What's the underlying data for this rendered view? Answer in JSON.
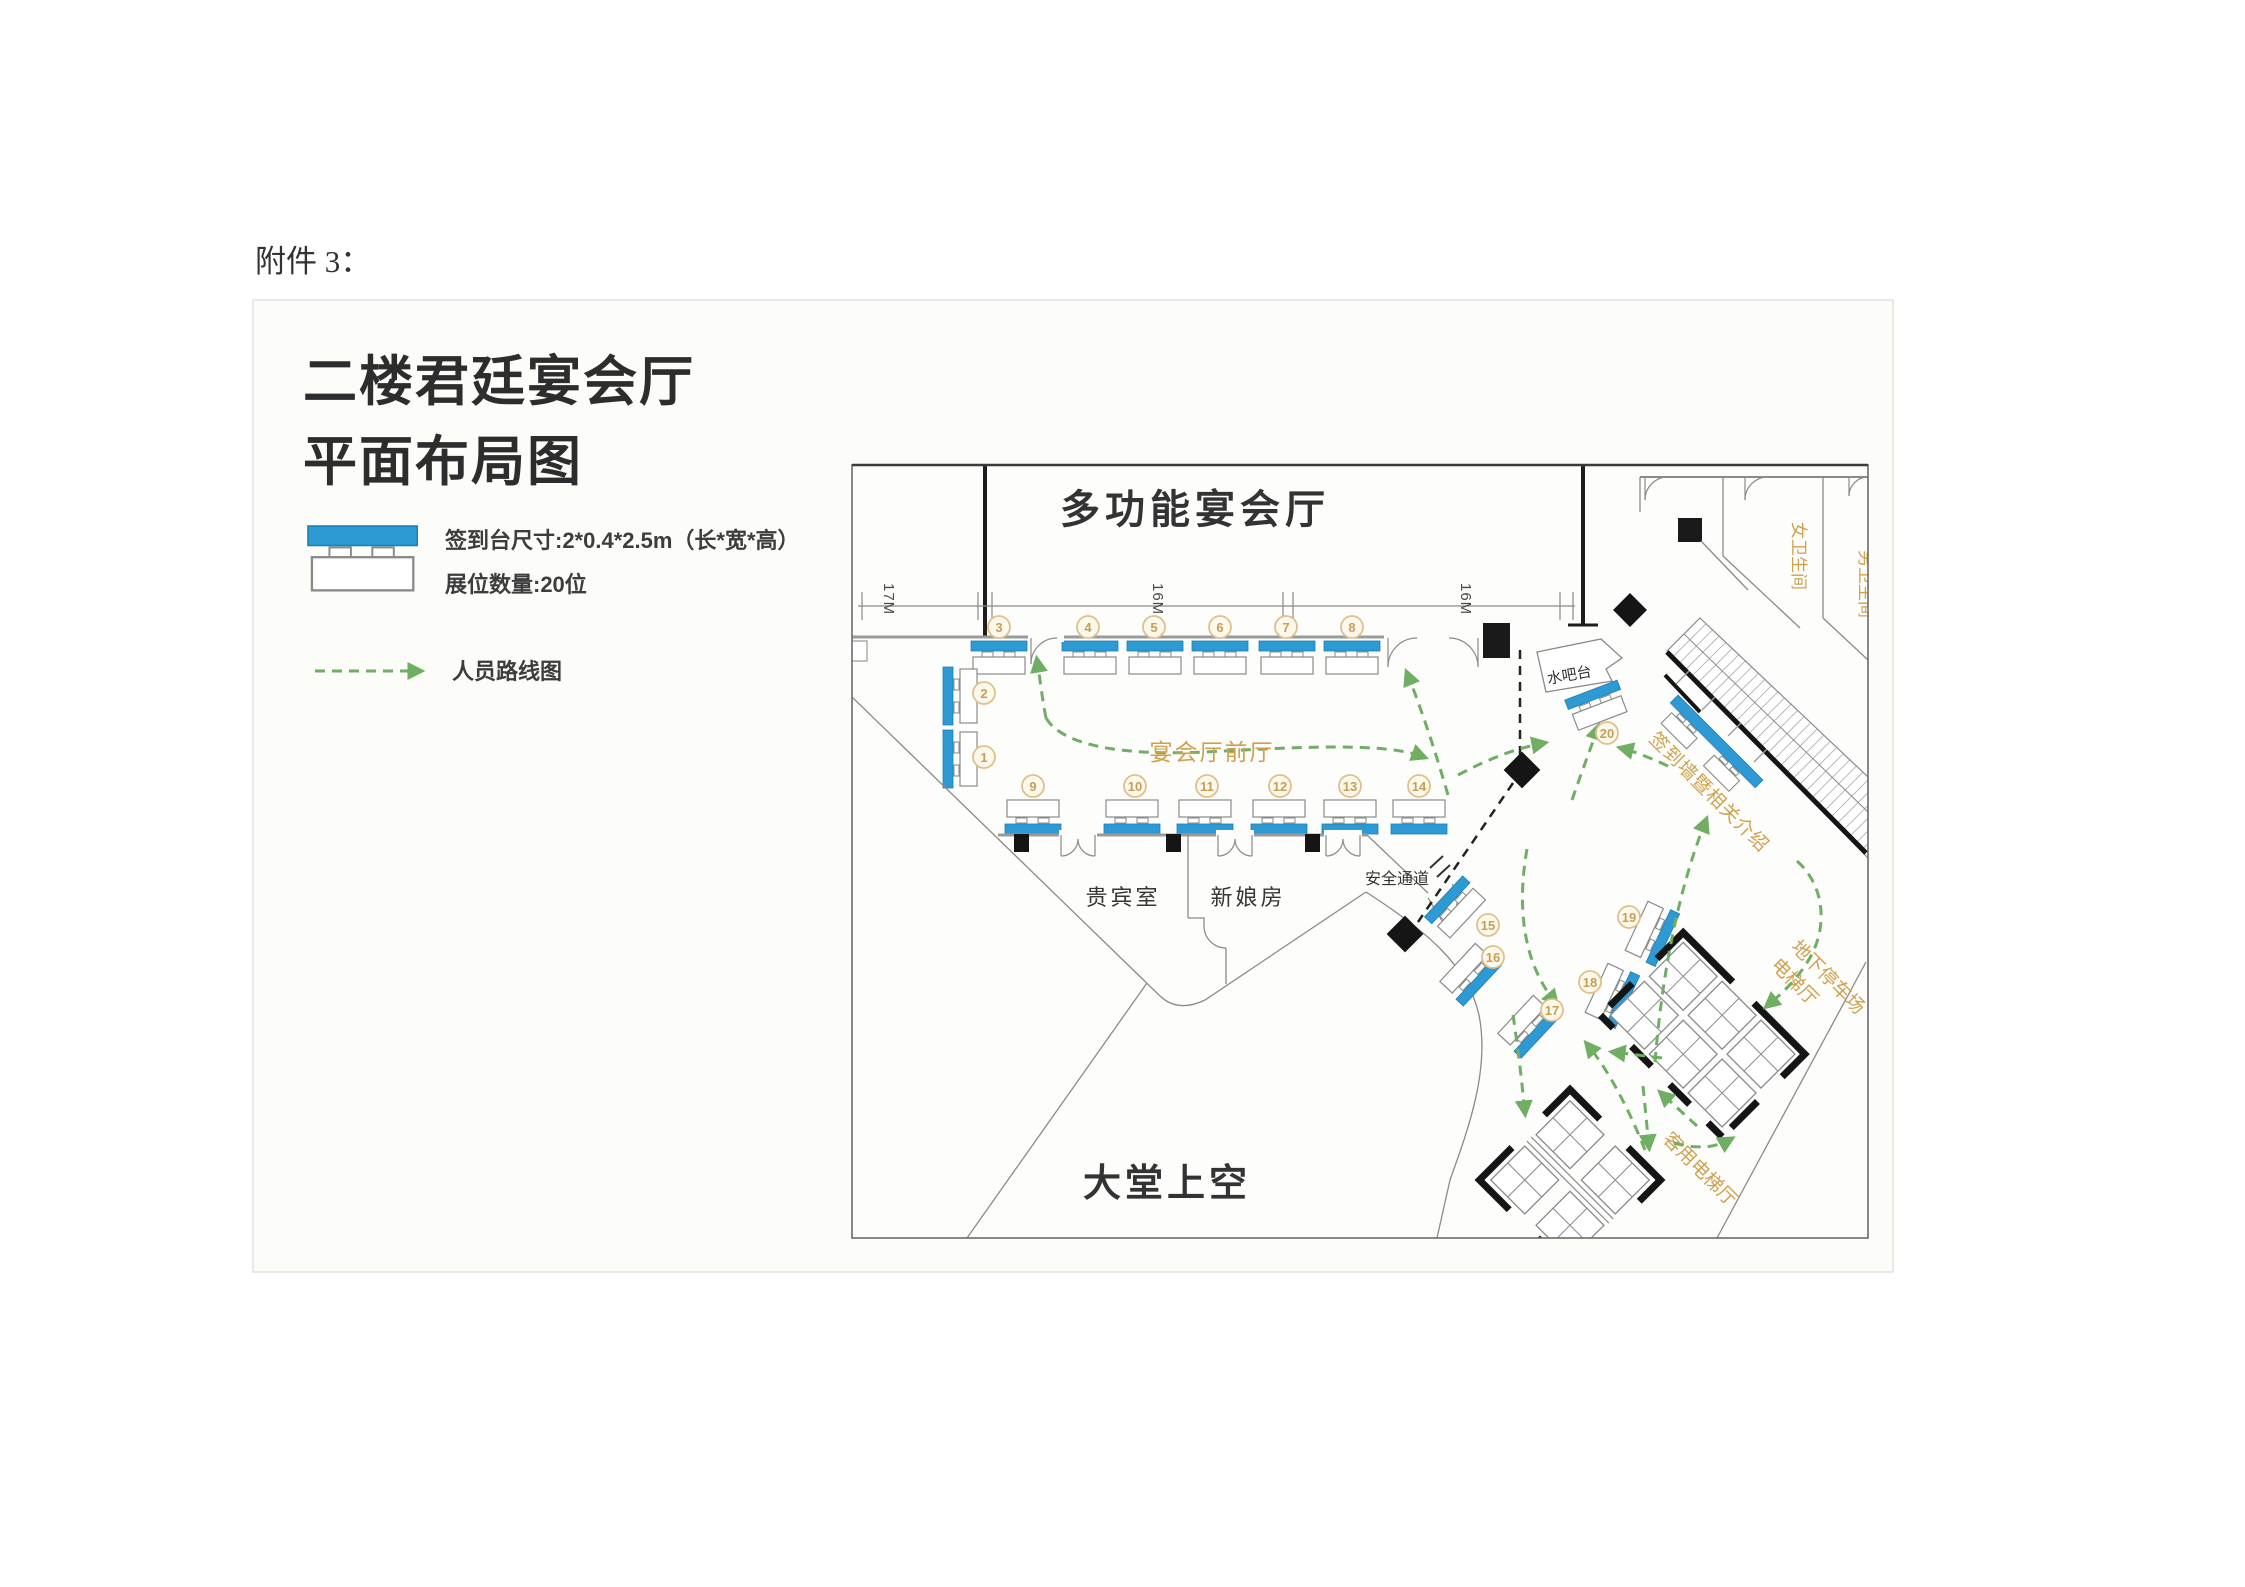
{
  "page": {
    "attachment_label": "附件 3："
  },
  "figure": {
    "title": {
      "line1": "二楼君廷宴会厅",
      "line2": "平面布局图"
    },
    "legend": {
      "signin_desk_spec": "签到台尺寸:2*0.4*2.5m（长*宽*高）",
      "booth_count": "展位数量:20位",
      "route_label": "人员路线图"
    },
    "plan": {
      "rooms": {
        "multifunction_hall": "多功能宴会厅",
        "banquet_foyer": "宴会厅前厅",
        "vip_room": "贵宾室",
        "bridal_room": "新娘房",
        "safety_passage": "安全通道",
        "water_bar": "水吧台",
        "lobby_void": "大堂上空",
        "womens_restroom": "女卫生间",
        "mens_restroom": "男卫生间",
        "signin_wall": "签到墙暨相关介绍",
        "parking_elevator_line1": "地下停车场",
        "parking_elevator_line2": "电梯厅",
        "guest_elevator": "客用电梯厅"
      },
      "dim_labels": [
        "17M",
        "16M",
        "16M"
      ],
      "booth_labels": [
        "1",
        "2",
        "3",
        "4",
        "5",
        "6",
        "7",
        "8",
        "9",
        "10",
        "11",
        "12",
        "13",
        "14",
        "15",
        "16",
        "17",
        "18",
        "19",
        "20"
      ]
    },
    "colors": {
      "booth_blue": "#2d9ad3",
      "route_green": "#6fae63",
      "label_tan": "#cfa14e",
      "wall_black": "#1e1e1e"
    }
  }
}
